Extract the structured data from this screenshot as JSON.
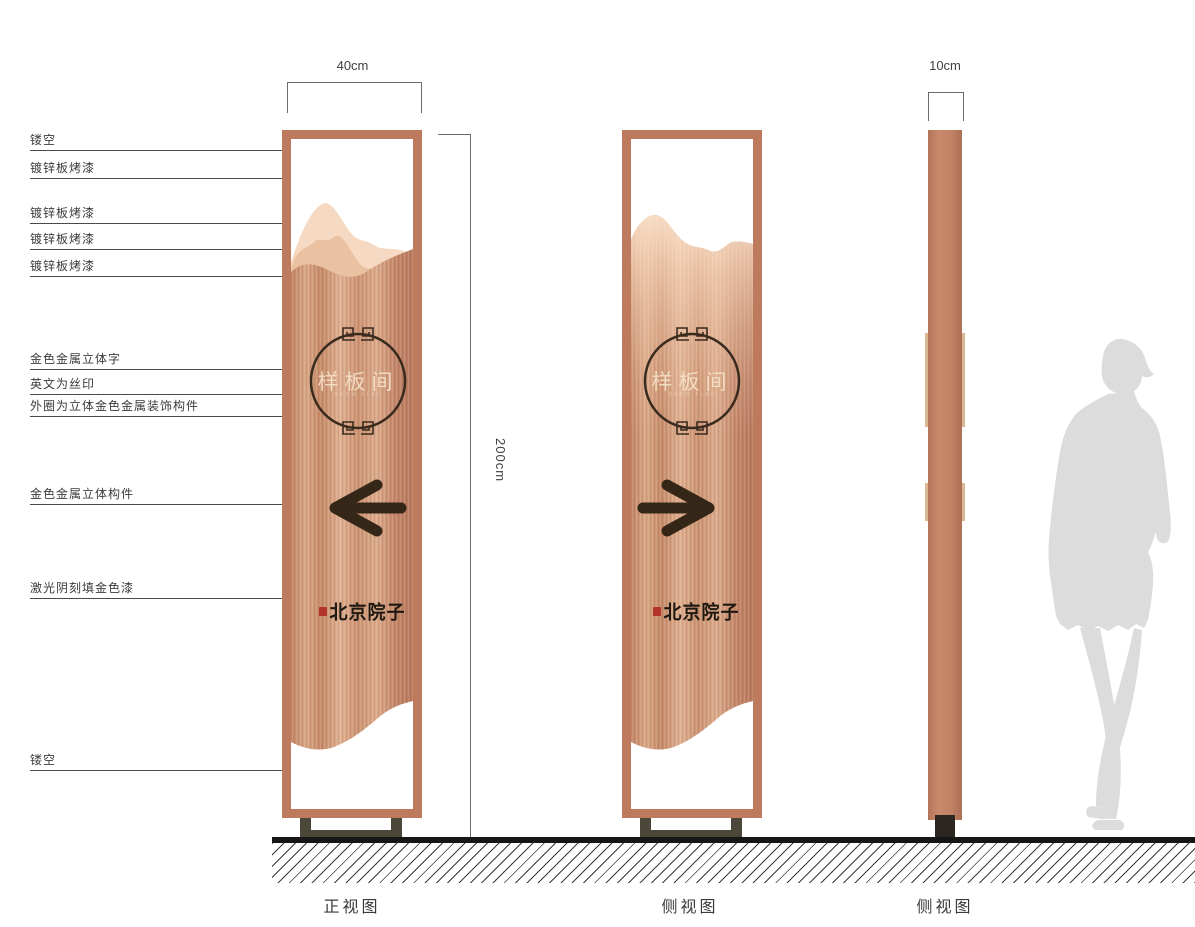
{
  "callouts": {
    "items": [
      {
        "label": "镂空"
      },
      {
        "label": "镀锌板烤漆"
      },
      {
        "label": "镀锌板烤漆"
      },
      {
        "label": "镀锌板烤漆"
      },
      {
        "label": "镀锌板烤漆"
      },
      {
        "label": "金色金属立体字"
      },
      {
        "label": "英文为丝印"
      },
      {
        "label": "外圈为立体金色金属装饰构件"
      },
      {
        "label": "金色金属立体构件"
      },
      {
        "label": "激光阴刻填金色漆"
      },
      {
        "label": "镂空"
      }
    ]
  },
  "dimensions": {
    "front_width": "40cm",
    "profile_width": "10cm",
    "height": "200cm"
  },
  "front_panel": {
    "caption": "正视图",
    "circle_text": "样板间",
    "circle_subtext_en": "SHOW FLAT",
    "logo_text": "北京院子",
    "arrow_icon": "arrow-left-icon"
  },
  "side_panel": {
    "caption": "侧视图",
    "circle_text": "样板间",
    "circle_subtext_en": "SHOW FLAT",
    "logo_text": "北京院子",
    "arrow_icon": "arrow-right-icon"
  },
  "profile_panel": {
    "caption": "侧视图"
  },
  "colors": {
    "frame_copper": "#bd7a5c",
    "panel_copper": "#cd9478",
    "mountain_light": "#f5d9c2",
    "mountain_mid": "#eac2a2",
    "ornament_dark": "#3a2b1f",
    "arrow_dark": "#352717",
    "logo_black": "#1f1810",
    "seal_red": "#b5342a",
    "stand_olive": "#4b4839",
    "silhouette_gray": "#dcdcdc",
    "ground_black": "#161616"
  }
}
